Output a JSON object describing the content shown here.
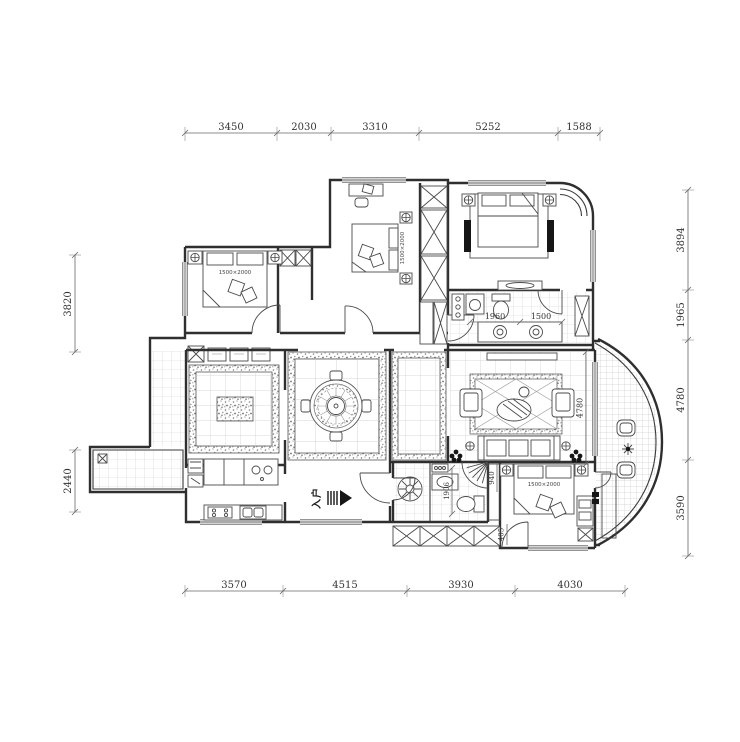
{
  "title": "apartment-floor-plan",
  "colors": {
    "background": "#ffffff",
    "wall": "#2f2f2f",
    "furniture": "#4a4a4a",
    "tile": "#c9c9c9",
    "dimension": "#666666",
    "text": "#333333"
  },
  "dims": {
    "top": [
      "3450",
      "2030",
      "3310",
      "5252",
      "1588"
    ],
    "bottom": [
      "3570",
      "4515",
      "3930",
      "4030"
    ],
    "left": [
      "3820",
      "2440"
    ],
    "right": [
      "3894",
      "1965",
      "4780",
      "3590"
    ],
    "inner": {
      "bath_left": "1960",
      "bath_right": "1500",
      "living_height": "4780",
      "bath2_height": "1906",
      "closet": "940",
      "door": "405"
    }
  },
  "labels": {
    "entry": "入户",
    "bed_topleft": "1500×2000",
    "bed_middle": "1500×2000",
    "bed_bottomright": "1500×2000"
  }
}
